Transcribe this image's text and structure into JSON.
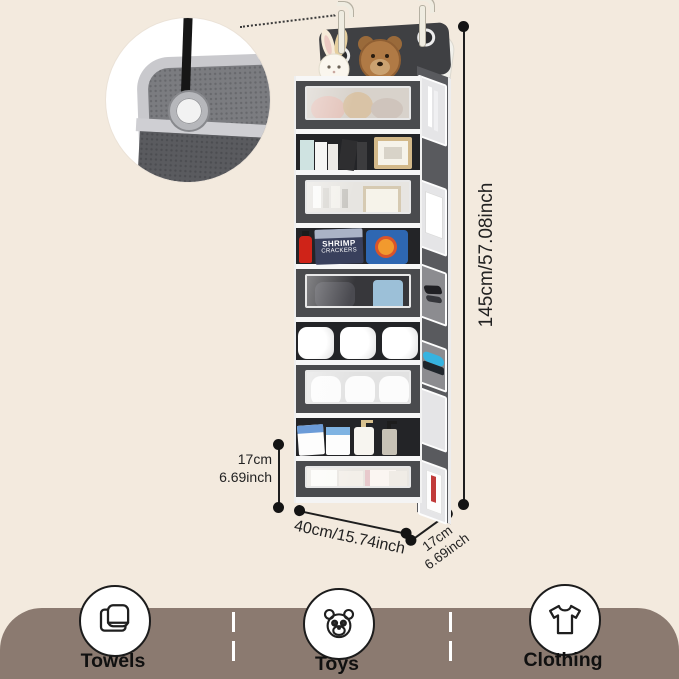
{
  "dimensions": {
    "height_label": "145cm/57.08inch",
    "pocket_height_line1": "17cm",
    "pocket_height_line2": "6.69inch",
    "width_label": "40cm/15.74inch",
    "depth_line1": "17cm",
    "depth_line2": "6.69inch"
  },
  "organizer": {
    "snack_bag": {
      "line1": "SHRIMP",
      "line2": "CRACKERS"
    }
  },
  "footer": {
    "categories": [
      {
        "label": "Towels",
        "icon": "towel-icon"
      },
      {
        "label": "Toys",
        "icon": "teddy-bear-icon"
      },
      {
        "label": "Clothing",
        "icon": "tshirt-icon"
      }
    ],
    "band_color": "#8b7a70"
  },
  "colors": {
    "background": "#f3eade",
    "fabric_dark": "#4a4b4e",
    "trim_white": "#f7f7f7",
    "dimension_line": "#1e1e1e"
  }
}
